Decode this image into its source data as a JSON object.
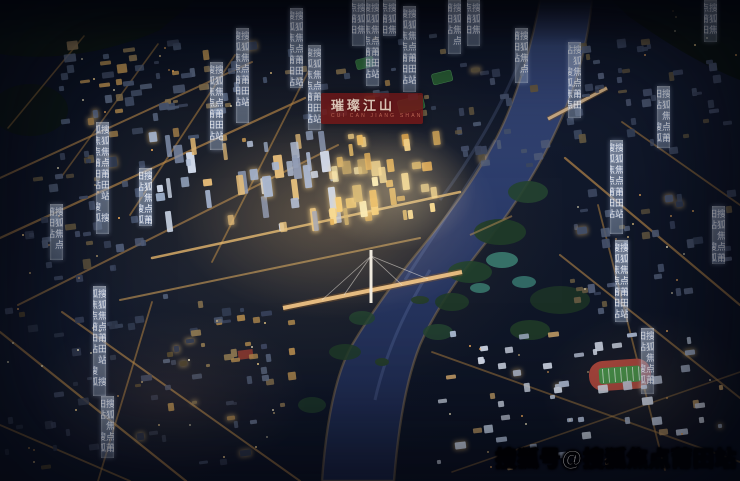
{
  "logo": {
    "icon": "flower-icon",
    "title": "璀璨江山",
    "subtitle": "CUI CAN JIANG SHAN",
    "plaque_color": "#7a1d1d"
  },
  "watermarks": {
    "bottom_right": "搜狐号@搜狐焦点莆田站",
    "strip_text": "搜狐焦点莆田站"
  },
  "palette": {
    "night_sky": "#0c1220",
    "river_top": "#33446f",
    "river_bottom": "#1b2647",
    "city_glow_warm": "#e8b45a",
    "tower_cool": "#bcc9de",
    "park_green": "#27482f",
    "track_red": "#a8423a",
    "field_green": "#3f8f46",
    "strip_tint": "#cfdcf0"
  }
}
